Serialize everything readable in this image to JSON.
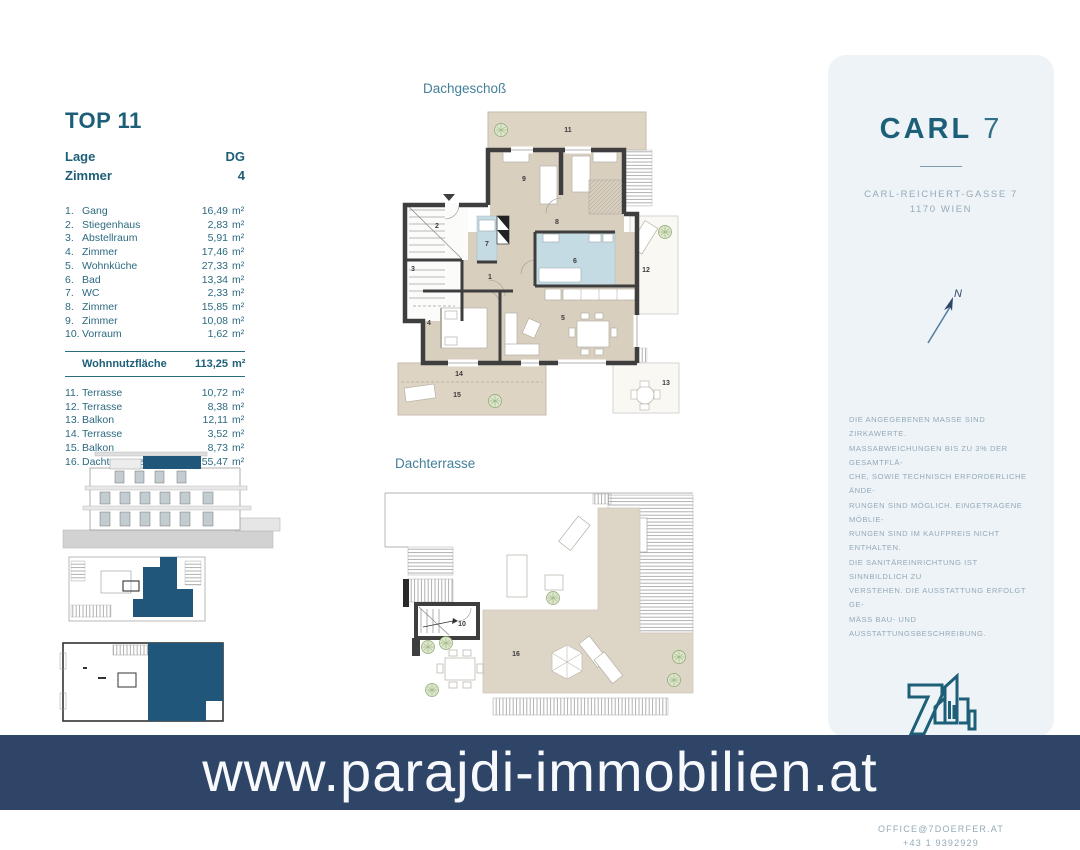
{
  "colors": {
    "accent_teal": "#1d5f78",
    "banner_bg": "#2e4568",
    "highlight_blue": "#20567a",
    "panel_bg": "#eef3f7",
    "plan_beige": "#ddd3c3",
    "plan_bath_blue": "#c5dbe4"
  },
  "unit_info": {
    "title": "TOP 11",
    "meta": [
      {
        "label": "Lage",
        "value": "DG"
      },
      {
        "label": "Zimmer",
        "value": "4"
      }
    ],
    "rooms": [
      {
        "nr": "1.",
        "name": "Gang",
        "area": "16,49",
        "unit": "m²"
      },
      {
        "nr": "2.",
        "name": "Stiegenhaus",
        "area": "2,83",
        "unit": "m²"
      },
      {
        "nr": "3.",
        "name": "Abstellraum",
        "area": "5,91",
        "unit": "m²"
      },
      {
        "nr": "4.",
        "name": "Zimmer",
        "area": "17,46",
        "unit": "m²"
      },
      {
        "nr": "5.",
        "name": "Wohnküche",
        "area": "27,33",
        "unit": "m²"
      },
      {
        "nr": "6.",
        "name": "Bad",
        "area": "13,34",
        "unit": "m²"
      },
      {
        "nr": "7.",
        "name": "WC",
        "area": "2,33",
        "unit": "m²"
      },
      {
        "nr": "8.",
        "name": "Zimmer",
        "area": "15,85",
        "unit": "m²"
      },
      {
        "nr": "9.",
        "name": "Zimmer",
        "area": "10,08",
        "unit": "m²"
      },
      {
        "nr": "10.",
        "name": "Vorraum",
        "area": "1,62",
        "unit": "m²"
      }
    ],
    "total": {
      "label": "Wohnnutzfläche",
      "area": "113,25",
      "unit": "m²"
    },
    "outdoor": [
      {
        "nr": "11.",
        "name": "Terrasse",
        "area": "10,72",
        "unit": "m²"
      },
      {
        "nr": "12.",
        "name": "Terrasse",
        "area": "8,38",
        "unit": "m²"
      },
      {
        "nr": "13.",
        "name": "Balkon",
        "area": "12,11",
        "unit": "m²"
      },
      {
        "nr": "14.",
        "name": "Terrasse",
        "area": "3,52",
        "unit": "m²"
      },
      {
        "nr": "15.",
        "name": "Balkon",
        "area": "8,73",
        "unit": "m²"
      },
      {
        "nr": "16.",
        "name": "Dachterrasse",
        "area": "55,47",
        "unit": "m²"
      }
    ]
  },
  "plans": {
    "dachgeschoss": {
      "title": "Dachgeschoß",
      "labels": {
        "r1": "1",
        "r2": "2",
        "r3": "3",
        "r4": "4",
        "r5": "5",
        "r6": "6",
        "r7": "7",
        "r8": "8",
        "r9": "9",
        "r11": "11",
        "r12": "12",
        "r13": "13",
        "r14": "14",
        "r15": "15"
      }
    },
    "dachterrasse": {
      "title": "Dachterrasse",
      "labels": {
        "r10": "10",
        "r16": "16"
      }
    }
  },
  "project_panel": {
    "name": "CARL",
    "number": "7",
    "address_line1": "CARL-REICHERT-GASSE 7",
    "address_line2": "1170 WIEN",
    "compass_label": "N",
    "disclaimer_lines": [
      "DIE ANGEGEBENEN MASSE SIND ZIRKAWERTE.",
      "MASSABWEICHUNGEN BIS ZU 3% DER GESAMTFLÄ-",
      "CHE, SOWIE TECHNISCH ERFORDERLICHE ÄNDE-",
      "RUNGEN SIND MÖGLICH. EINGETRAGENE MÖBLIE-",
      "RUNGEN SIND IM KAUFPREIS NICHT ENTHALTEN.",
      "DIE SANITÄREINRICHTUNG IST SINNBILDLICH ZU",
      "VERSTEHEN. DIE AUSSTATTUNG ERFOLGT GE-",
      "MÄSS BAU- UND AUSSTATTUNGSBESCHREIBUNG."
    ],
    "company": "SIEBEN DÖRFER IMMOBILIEN",
    "company_address1": "MARC-AUREL-STRASSE 4/16",
    "company_address2": "1010 WIEN",
    "email": "OFFICE@7DOERFER.AT",
    "phone": "+43 1 9392929"
  },
  "banner": {
    "website": "www.parajdi-immobilien.at"
  }
}
